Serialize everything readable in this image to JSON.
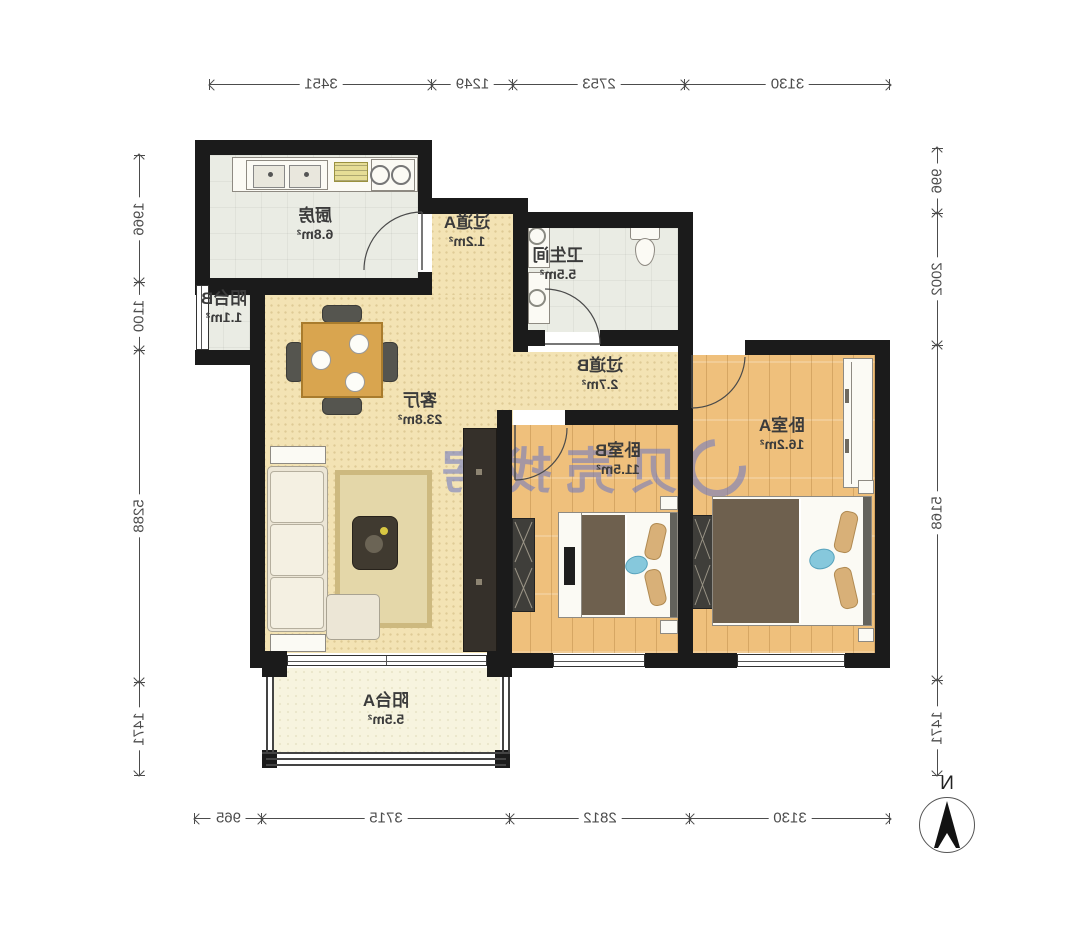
{
  "plan_title": "两室一厅户型图",
  "watermark": {
    "brand": "贝壳找房"
  },
  "compass": {
    "north_label": "N"
  },
  "rooms": [
    {
      "id": "kitchen",
      "name": "厨房",
      "area": "6.8m²"
    },
    {
      "id": "hallway-a",
      "name": "过道A",
      "area": "1.2m²"
    },
    {
      "id": "bathroom",
      "name": "卫生间",
      "area": "5.5m²"
    },
    {
      "id": "balcony-b",
      "name": "阳台B",
      "area": "1.1m²"
    },
    {
      "id": "living-room",
      "name": "客厅",
      "area": "23.8m²"
    },
    {
      "id": "hallway-b",
      "name": "过道B",
      "area": "2.7m²"
    },
    {
      "id": "bedroom-b",
      "name": "卧室B",
      "area": "11.5m²"
    },
    {
      "id": "bedroom-a",
      "name": "卧室A",
      "area": "16.2m²"
    },
    {
      "id": "balcony-a",
      "name": "阳台A",
      "area": "5.5m²"
    }
  ],
  "dims": {
    "top": [
      "3130",
      "2753",
      "1249",
      "3451"
    ],
    "bottom": [
      "3130",
      "2812",
      "3715",
      "965"
    ],
    "left_side": [
      "996",
      "2002",
      "5168",
      "1471"
    ],
    "right_side": [
      "1966",
      "1100",
      "5288",
      "1471"
    ]
  },
  "colors": {
    "wall": "#1b1b1b",
    "wood_floor": "#efc07c",
    "cream_floor": "#f3e3b4",
    "tile_floor": "#eaece4",
    "balcony_floor": "#f7f4df",
    "watermark": "#6a76c4",
    "dimension_text": "#4c4c4c"
  },
  "note_mirrored": "整图水平镜像显示"
}
